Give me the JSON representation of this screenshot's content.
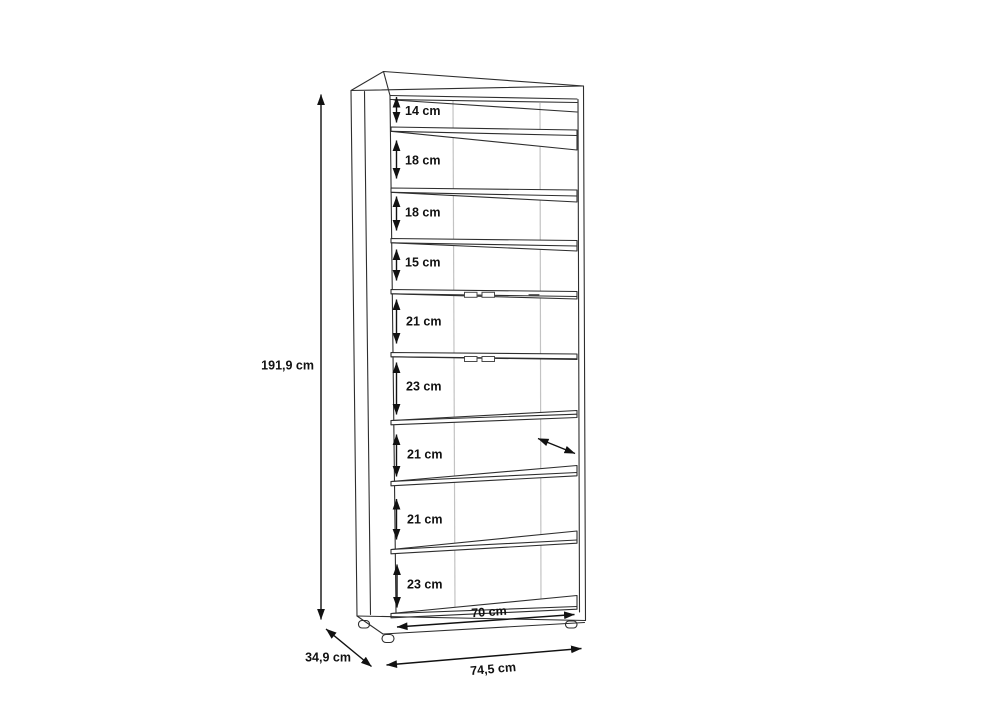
{
  "drawing": {
    "title": "shelf-cabinet-dimension-diagram",
    "height_label": "191,9 cm",
    "depth_label": "34,9 cm",
    "outer_width_label": "74,5 cm",
    "inner_width_label": "70 cm",
    "compartments": [
      {
        "label": "14 cm"
      },
      {
        "label": "18 cm"
      },
      {
        "label": "18 cm"
      },
      {
        "label": "15 cm"
      },
      {
        "label": "21 cm"
      },
      {
        "label": "23 cm"
      },
      {
        "label": "21 cm"
      },
      {
        "label": "21 cm"
      },
      {
        "label": "23 cm"
      }
    ],
    "colors": {
      "background": "#ffffff",
      "line": "#2e2e2e",
      "seam": "#c3c3c3",
      "text": "#111111"
    }
  }
}
